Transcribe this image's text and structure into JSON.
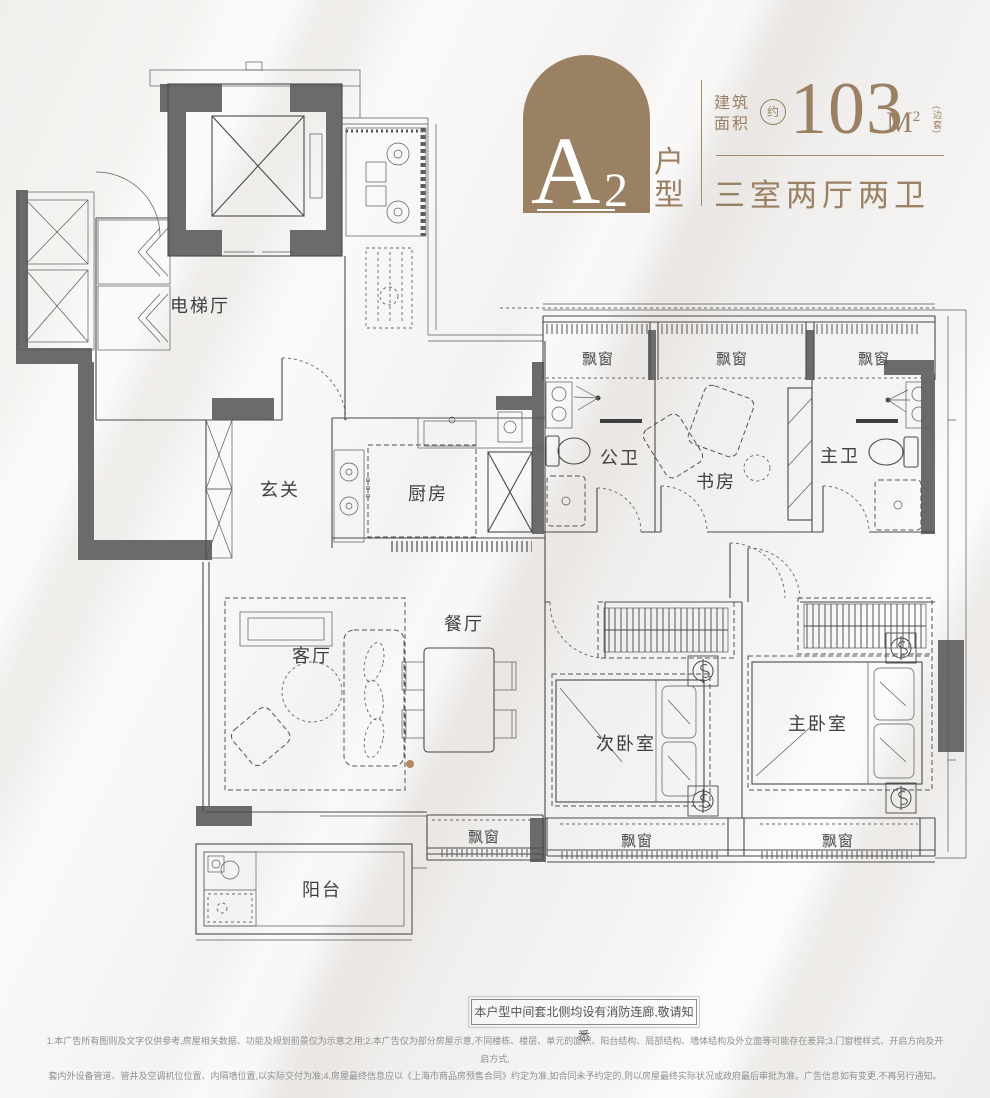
{
  "header": {
    "unit_letter": "A",
    "unit_number": "2",
    "unit_suffix_1": "户",
    "unit_suffix_2": "型",
    "area_label_1": "建筑",
    "area_label_2": "面积",
    "area_approx": "约",
    "area_value": "103",
    "area_unit": "M",
    "area_unit_sup": "2",
    "area_note": "(边套)",
    "layout_desc": "三室两厅两卫"
  },
  "plan": {
    "rooms": {
      "elevator_hall": "电梯厅",
      "foyer": "玄关",
      "kitchen": "厨房",
      "public_bath": "公卫",
      "study": "书房",
      "master_bath": "主卫",
      "living": "客厅",
      "dining": "餐厅",
      "second_bedroom": "次卧室",
      "master_bedroom": "主卧室",
      "balcony": "阳台",
      "bay_window": "飘窗"
    }
  },
  "notes": {
    "fire_corridor": "本户型中间套北侧均设有消防连廊,敬请知悉",
    "disclaimer_line1": "1.本广告所有图则及文字仅供参考,房屋相关数据、功能及规划前景仅为示意之用;2.本广告仅为部分房屋示意,不同楼栋、楼层、单元的面积、阳台结构、局部结构、墙体结构及外立面等可能存在差异;3.门窗樘样式、开启方向及开启方式,",
    "disclaimer_line2": "套内外设备管道、管井及空调机位位置、内隔墙位置,以实际交付为准;4.房屋最终信息应以《上海市商品房预售合同》约定为准,如合同未予约定的,则以房屋最终实际状况或政府最后审批为准。广告信息如有变更,不再另行通知。"
  },
  "colors": {
    "brand": "#9a8164",
    "wall": "#6b6b6b",
    "line": "#4a4a4a",
    "text": "#3f3f3f"
  }
}
